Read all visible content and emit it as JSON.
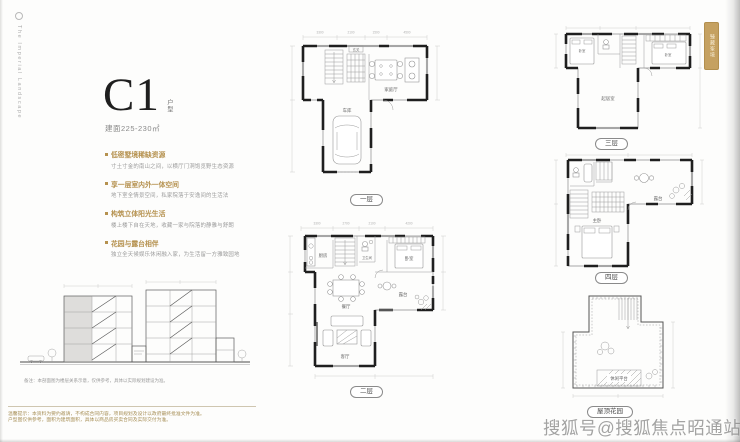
{
  "brand": {
    "logo_text": "The Imperial Landscape",
    "seal_text": "臻藏峯境"
  },
  "unit": {
    "name": "C1",
    "name_suffix": "户型",
    "area": "建面225-230㎡"
  },
  "features": [
    {
      "title": "低密墅境稀缺资源",
      "body": "寸土寸金的南山之间，以横厅门洞饱览野生态资源"
    },
    {
      "title": "享一层室内外一体空间",
      "body": "地下室全情景空间，私家院落于安逸间的生活法"
    },
    {
      "title": "构筑立体阳光生活",
      "body": "楼上楼下自在天地，收藏一家与院落的静雅与舒朗"
    },
    {
      "title": "花园与露台相伴",
      "body": "独立全天候娱乐休闲融入家，为生活留一方雅致园地"
    }
  ],
  "section": {
    "caption": "备注：本剖面图为楼层关系示意，仅供参考，具体以实际规划建设为准。"
  },
  "disclaimer": {
    "line1": "温馨提示：本资料为要约邀请，不构成合同内容，项目规划及设计以政府最终批准文件为准。",
    "line2": "户型图仅供参考，面积为建筑面积，具体以商品房买卖合同及实际交付为准。"
  },
  "plans": {
    "floor1": {
      "label": "一层",
      "rooms": {
        "foyer": "玄关",
        "family": "家庭厅",
        "garage": "车库"
      },
      "dims": [
        "3300",
        "2100",
        "1500",
        "4500"
      ]
    },
    "floor2": {
      "label": "二层",
      "rooms": {
        "kitchen": "厨房",
        "bath": "卫生间",
        "bedroom": "卧室",
        "dining": "餐厅",
        "terrace": "露台",
        "living": "客厅"
      },
      "dims": [
        "3300",
        "2700",
        "2100",
        "4200"
      ]
    },
    "floor3": {
      "label": "三层",
      "rooms": {
        "bedroom_l": "卧室",
        "bedroom_r": "卧室",
        "lounge": "起居室"
      }
    },
    "floor4": {
      "label": "四层",
      "rooms": {
        "master": "主卧",
        "terrace": "露台"
      }
    },
    "roof": {
      "label": "屋顶花园",
      "rooms": {
        "garden": "休闲平台"
      }
    }
  },
  "watermark": "搜狐号@搜狐焦点昭通站",
  "colors": {
    "gold": "#b5914e",
    "wall": "#1f1f1f",
    "seal": "#c5a161"
  }
}
